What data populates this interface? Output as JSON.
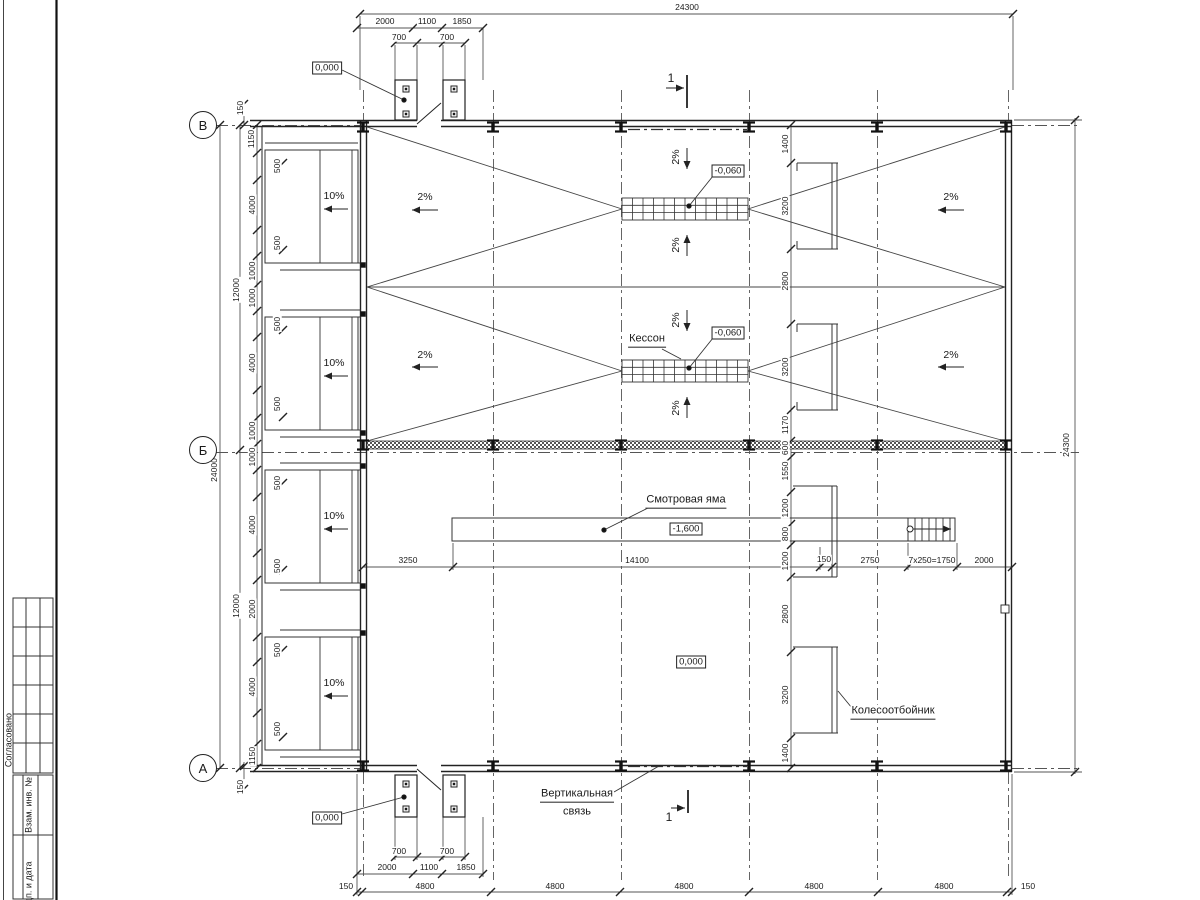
{
  "sheet": {
    "side_sections": {
      "approved": "Согласовано",
      "replacement": "Взам. инв. №",
      "signature": "Подп. и дата"
    }
  },
  "axis_circles": [
    {
      "t": "В",
      "x": 203,
      "y": 125
    },
    {
      "t": "Б",
      "x": 203,
      "y": 450
    },
    {
      "t": "А",
      "x": 203,
      "y": 768
    }
  ],
  "callouts": {
    "caisson": "Кессон",
    "inspection_pit": "Смотровая яма",
    "wheel_guard": "Колесоотбойник",
    "vertical_bracing_1": "Вертикальная",
    "vertical_bracing_2": "связь"
  },
  "elevation_marks": [
    {
      "t": "0,000",
      "x": 327,
      "y": 68
    },
    {
      "t": "-0,060",
      "x": 728,
      "y": 171
    },
    {
      "t": "-0,060",
      "x": 728,
      "y": 333
    },
    {
      "t": "-1,600",
      "x": 686,
      "y": 529
    },
    {
      "t": "0,000",
      "x": 691,
      "y": 662
    },
    {
      "t": "0,000",
      "x": 327,
      "y": 818
    }
  ],
  "section_marks": [
    {
      "t": "1",
      "x": 671,
      "y": 78
    },
    {
      "t": "1",
      "x": 669,
      "y": 817
    }
  ],
  "slope_labels": [
    {
      "t": "10%",
      "x": 334,
      "y": 196,
      "r": 0
    },
    {
      "t": "10%",
      "x": 334,
      "y": 363,
      "r": 0
    },
    {
      "t": "10%",
      "x": 334,
      "y": 516,
      "r": 0
    },
    {
      "t": "10%",
      "x": 334,
      "y": 683,
      "r": 0
    },
    {
      "t": "2%",
      "x": 425,
      "y": 197,
      "r": 0
    },
    {
      "t": "2%",
      "x": 425,
      "y": 355,
      "r": 0
    },
    {
      "t": "2%",
      "x": 951,
      "y": 197,
      "r": 0
    },
    {
      "t": "2%",
      "x": 951,
      "y": 355,
      "r": 0
    },
    {
      "t": "2%",
      "x": 676,
      "y": 157,
      "r": 1
    },
    {
      "t": "2%",
      "x": 676,
      "y": 245,
      "r": 1
    },
    {
      "t": "2%",
      "x": 676,
      "y": 320,
      "r": 1
    },
    {
      "t": "2%",
      "x": 676,
      "y": 408,
      "r": 1
    }
  ],
  "dim_labels": [
    {
      "t": "24300",
      "x": 687,
      "y": 7,
      "r": 0
    },
    {
      "t": "2000",
      "x": 385,
      "y": 21,
      "r": 0
    },
    {
      "t": "1100",
      "x": 427,
      "y": 21,
      "r": 0
    },
    {
      "t": "1850",
      "x": 462,
      "y": 21,
      "r": 0
    },
    {
      "t": "700",
      "x": 399,
      "y": 37,
      "r": 0
    },
    {
      "t": "700",
      "x": 447,
      "y": 37,
      "r": 0
    },
    {
      "t": "150",
      "x": 240,
      "y": 108,
      "r": 1
    },
    {
      "t": "1150",
      "x": 251,
      "y": 139,
      "r": 1
    },
    {
      "t": "500",
      "x": 277,
      "y": 166,
      "r": 1
    },
    {
      "t": "4000",
      "x": 252,
      "y": 205,
      "r": 1
    },
    {
      "t": "500",
      "x": 277,
      "y": 243,
      "r": 1
    },
    {
      "t": "1000",
      "x": 252,
      "y": 271,
      "r": 1
    },
    {
      "t": "1000",
      "x": 252,
      "y": 298,
      "r": 1
    },
    {
      "t": "500",
      "x": 277,
      "y": 324,
      "r": 1
    },
    {
      "t": "4000",
      "x": 252,
      "y": 363,
      "r": 1
    },
    {
      "t": "500",
      "x": 277,
      "y": 404,
      "r": 1
    },
    {
      "t": "1000",
      "x": 252,
      "y": 431,
      "r": 1
    },
    {
      "t": "1000",
      "x": 252,
      "y": 457,
      "r": 1
    },
    {
      "t": "500",
      "x": 277,
      "y": 483,
      "r": 1
    },
    {
      "t": "4000",
      "x": 252,
      "y": 525,
      "r": 1
    },
    {
      "t": "500",
      "x": 277,
      "y": 566,
      "r": 1
    },
    {
      "t": "2000",
      "x": 252,
      "y": 609,
      "r": 1
    },
    {
      "t": "500",
      "x": 277,
      "y": 650,
      "r": 1
    },
    {
      "t": "4000",
      "x": 252,
      "y": 687,
      "r": 1
    },
    {
      "t": "500",
      "x": 277,
      "y": 729,
      "r": 1
    },
    {
      "t": "1150",
      "x": 252,
      "y": 756,
      "r": 1
    },
    {
      "t": "150",
      "x": 240,
      "y": 787,
      "r": 1
    },
    {
      "t": "12000",
      "x": 236,
      "y": 290,
      "r": 1
    },
    {
      "t": "12000",
      "x": 236,
      "y": 606,
      "r": 1
    },
    {
      "t": "24000",
      "x": 214,
      "y": 470,
      "r": 1
    },
    {
      "t": "1400",
      "x": 785,
      "y": 144,
      "r": 1
    },
    {
      "t": "3200",
      "x": 785,
      "y": 206,
      "r": 1
    },
    {
      "t": "2800",
      "x": 785,
      "y": 281,
      "r": 1
    },
    {
      "t": "3200",
      "x": 785,
      "y": 367,
      "r": 1
    },
    {
      "t": "1170",
      "x": 785,
      "y": 425,
      "r": 1
    },
    {
      "t": "600",
      "x": 785,
      "y": 448,
      "r": 1
    },
    {
      "t": "1550",
      "x": 785,
      "y": 471,
      "r": 1
    },
    {
      "t": "1200",
      "x": 785,
      "y": 508,
      "r": 1
    },
    {
      "t": "800",
      "x": 785,
      "y": 534,
      "r": 1
    },
    {
      "t": "1200",
      "x": 785,
      "y": 561,
      "r": 1
    },
    {
      "t": "2800",
      "x": 785,
      "y": 614,
      "r": 1
    },
    {
      "t": "3200",
      "x": 785,
      "y": 695,
      "r": 1
    },
    {
      "t": "1400",
      "x": 785,
      "y": 753,
      "r": 1
    },
    {
      "t": "24300",
      "x": 1066,
      "y": 445,
      "r": 1
    },
    {
      "t": "3250",
      "x": 408,
      "y": 560,
      "r": 0
    },
    {
      "t": "14100",
      "x": 637,
      "y": 560,
      "r": 0
    },
    {
      "t": "150",
      "x": 824,
      "y": 559,
      "r": 0
    },
    {
      "t": "2750",
      "x": 870,
      "y": 560,
      "r": 0
    },
    {
      "t": "7x250=1750",
      "x": 932,
      "y": 560,
      "r": 0
    },
    {
      "t": "2000",
      "x": 984,
      "y": 560,
      "r": 0
    },
    {
      "t": "700",
      "x": 399,
      "y": 851,
      "r": 0
    },
    {
      "t": "700",
      "x": 447,
      "y": 851,
      "r": 0
    },
    {
      "t": "2000",
      "x": 387,
      "y": 867,
      "r": 0
    },
    {
      "t": "1100",
      "x": 429,
      "y": 867,
      "r": 0
    },
    {
      "t": "1850",
      "x": 466,
      "y": 867,
      "r": 0
    },
    {
      "t": "150",
      "x": 346,
      "y": 886,
      "r": 0
    },
    {
      "t": "4800",
      "x": 425,
      "y": 886,
      "r": 0
    },
    {
      "t": "4800",
      "x": 555,
      "y": 886,
      "r": 0
    },
    {
      "t": "4800",
      "x": 684,
      "y": 886,
      "r": 0
    },
    {
      "t": "4800",
      "x": 814,
      "y": 886,
      "r": 0
    },
    {
      "t": "4800",
      "x": 944,
      "y": 886,
      "r": 0
    },
    {
      "t": "150",
      "x": 1028,
      "y": 886,
      "r": 0
    }
  ]
}
